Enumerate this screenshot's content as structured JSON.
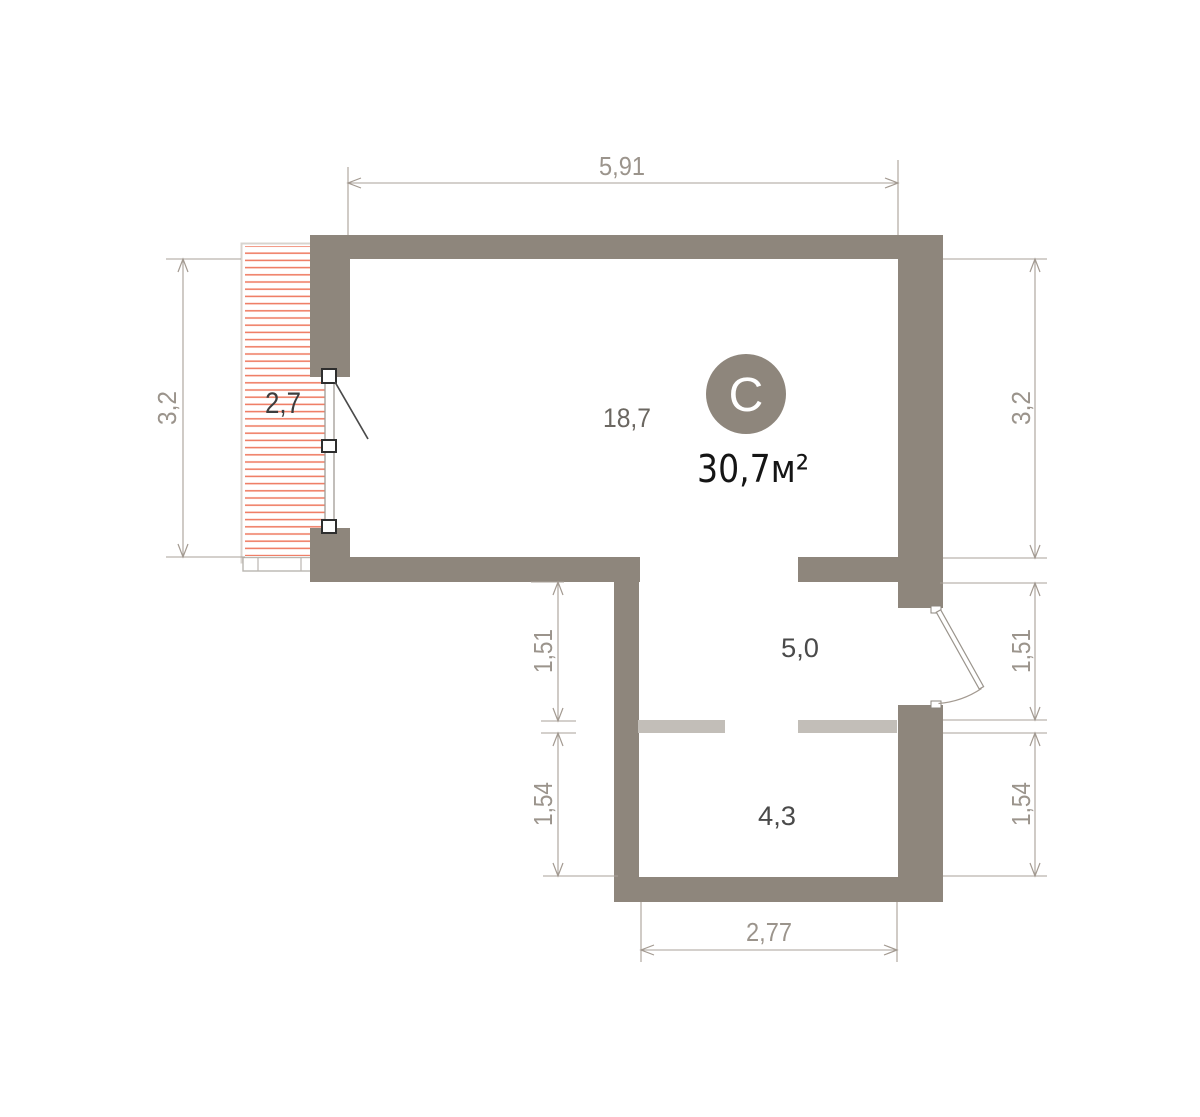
{
  "unit": {
    "type_badge": "С",
    "total_area": "30,7м²"
  },
  "rooms": {
    "balcony": "2,7",
    "living": "18,7",
    "hallway": "5,0",
    "bathroom": "4,3"
  },
  "dimensions": {
    "top_width": "5,91",
    "left_height": "3,2",
    "right_height": "3,2",
    "left_mid": "1,51",
    "left_lower": "1,54",
    "right_mid": "1,51",
    "right_lower": "1,54",
    "bottom_width": "2,77"
  },
  "colors": {
    "wall": "#8e867c",
    "partition": "#c2beb8",
    "hatch": "#ef7f67",
    "dim": "#a39a91",
    "badge": "#8e867c"
  }
}
